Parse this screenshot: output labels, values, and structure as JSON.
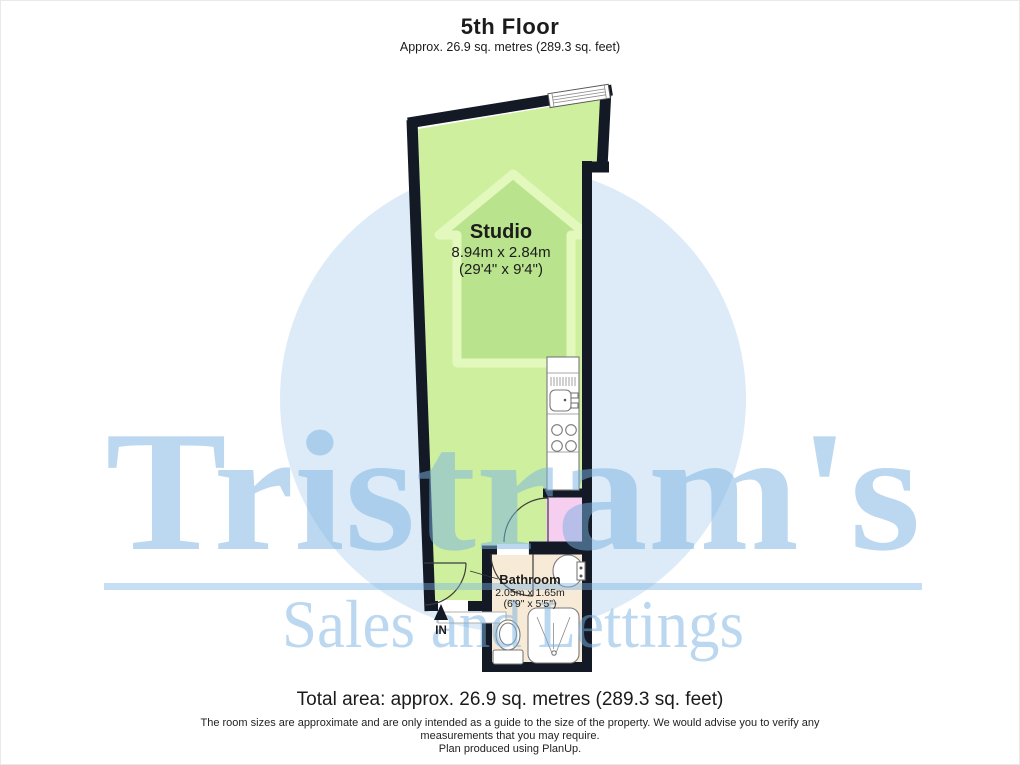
{
  "header": {
    "title": "5th Floor",
    "subtitle": "Approx. 26.9 sq. metres (289.3 sq. feet)"
  },
  "plan": {
    "studio": {
      "name": "Studio",
      "dims_metric": "8.94m x 2.84m",
      "dims_imperial": "(29'4\" x 9'4\")"
    },
    "bathroom": {
      "name": "Bathroom",
      "dims_metric": "2.05m x 1.65m",
      "dims_imperial": "(6'9\" x 5'5\")"
    },
    "entrance_label": "IN"
  },
  "watermark": {
    "brand": "Tristram's",
    "tagline": "Sales and Lettings"
  },
  "footer": {
    "total_area": "Total area: approx. 26.9 sq. metres (289.3 sq. feet)",
    "disclaimer_line1": "The room sizes are approximate and are only intended as a guide to the size of the property. We would advise you to verify any",
    "disclaimer_line2": "measurements that you may require.",
    "disclaimer_line3": "Plan produced using PlanUp."
  },
  "colors": {
    "wall": "#131a26",
    "studio_green": "#cdef9e",
    "house_green": "#b9e38c",
    "closet_pink": "#f6cef0",
    "bathroom_beige": "#f7ead6",
    "circle_blue": "#dcebf7",
    "watermark_blue": "#7ab2e2"
  }
}
